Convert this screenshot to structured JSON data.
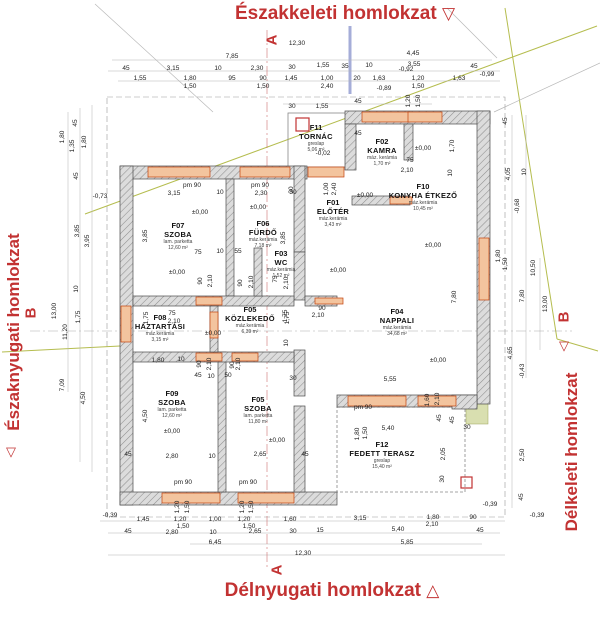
{
  "titles": {
    "top": "Északkeleti homlokzat",
    "bottom": "Délnyugati homlokzat",
    "left": "Északnyugati homlokzat",
    "right": "Délkeleti homlokzat"
  },
  "section_markers": {
    "top": "A",
    "bottom": "A",
    "left": "B",
    "right": "B"
  },
  "facade_triangles": {
    "top": "▽",
    "bottom": "△",
    "left": "▽",
    "right": "▽"
  },
  "colors": {
    "accent_red": "#c23232",
    "wall_hatch_gray": "#dcdcdc",
    "window_orange": "#e8955f",
    "roofline_olive": "#b5bd4f",
    "line_blue": "#8892cc"
  },
  "rooms": [
    {
      "code": "F11",
      "name": "TORNÁC",
      "finish": "greslap",
      "area": "5,06 m²",
      "x": 316,
      "y": 124
    },
    {
      "code": "F02",
      "name": "KAMRA",
      "finish": "máz. kerámia",
      "area": "1,70 m²",
      "x": 382,
      "y": 138
    },
    {
      "code": "F01",
      "name": "ELŐTÉR",
      "finish": "máz.kerámia",
      "area": "3,43 m²",
      "x": 333,
      "y": 199
    },
    {
      "code": "F10",
      "name": "KONYHA ÉTKEZŐ",
      "finish": "máz.kerámia",
      "area": "10,45 m²",
      "x": 423,
      "y": 183
    },
    {
      "code": "F07",
      "name": "SZOBA",
      "finish": "lam. parketta",
      "area": "12,60 m²",
      "x": 178,
      "y": 222
    },
    {
      "code": "F06",
      "name": "FÜRDŐ",
      "finish": "máz.kerámia",
      "area": "7,18 m²",
      "x": 263,
      "y": 220
    },
    {
      "code": "F03",
      "name": "WC",
      "finish": "máz.kerámia",
      "area": "1,52 m²",
      "x": 281,
      "y": 250
    },
    {
      "code": "F08",
      "name": "HÁZTARTÁSI",
      "finish": "máz.kerámia",
      "area": "3,15 m²",
      "x": 160,
      "y": 314
    },
    {
      "code": "F05",
      "name": "KÖZLEKEDŐ",
      "finish": "máz.kerámia",
      "area": "6,39 m²",
      "x": 250,
      "y": 306
    },
    {
      "code": "F04",
      "name": "NAPPALI",
      "finish": "máz.kerámia",
      "area": "34,68 m²",
      "x": 397,
      "y": 308
    },
    {
      "code": "F09",
      "name": "SZOBA",
      "finish": "lam. parketta",
      "area": "12,60 m²",
      "x": 172,
      "y": 390
    },
    {
      "code": "F05",
      "name": "SZOBA",
      "finish": "lam. parketta",
      "area": "11,80 m²",
      "x": 258,
      "y": 396
    },
    {
      "code": "F12",
      "name": "FEDETT TERASZ",
      "finish": "greslap",
      "area": "15,40 m²",
      "x": 382,
      "y": 441
    }
  ],
  "dimensions": [
    [
      "12,30",
      297,
      44
    ],
    [
      "7,85",
      232,
      57
    ],
    [
      "4,45",
      413,
      54
    ],
    [
      "45",
      126,
      69
    ],
    [
      "3,15",
      173,
      69
    ],
    [
      "10",
      218,
      69
    ],
    [
      "2,30",
      257,
      69
    ],
    [
      "30",
      292,
      68
    ],
    [
      "1,55",
      323,
      66
    ],
    [
      "35",
      345,
      67
    ],
    [
      "10",
      369,
      66
    ],
    [
      "3,55",
      414,
      65
    ],
    [
      "45",
      474,
      67
    ],
    [
      "1,55",
      140,
      79
    ],
    [
      "1,80",
      190,
      79
    ],
    [
      "1,50",
      190,
      87
    ],
    [
      "95",
      232,
      79
    ],
    [
      "90",
      263,
      79
    ],
    [
      "1,50",
      263,
      87
    ],
    [
      "1,45",
      291,
      79
    ],
    [
      "1,00",
      327,
      79
    ],
    [
      "2,40",
      327,
      87
    ],
    [
      "20",
      357,
      79
    ],
    [
      "1,63",
      379,
      79
    ],
    [
      "-0,92",
      406,
      70
    ],
    [
      "1,20",
      418,
      79
    ],
    [
      "1,50",
      418,
      87
    ],
    [
      "1,63",
      459,
      79
    ],
    [
      "-0,99",
      487,
      75
    ],
    [
      "-0,89",
      384,
      89
    ],
    [
      "30",
      292,
      107
    ],
    [
      "1,55",
      322,
      107
    ],
    [
      "45",
      358,
      102
    ],
    [
      "1,20",
      409,
      101,
      -90
    ],
    [
      "1,50",
      419,
      101,
      -90
    ],
    [
      "1,80",
      63,
      137,
      -90
    ],
    [
      "1,35",
      73,
      146,
      -90
    ],
    [
      "1,80",
      85,
      142,
      -90
    ],
    [
      "45",
      76,
      123,
      -90
    ],
    [
      "45",
      77,
      176,
      -90
    ],
    [
      "-0,73",
      100,
      197
    ],
    [
      "3,85",
      78,
      231,
      -90
    ],
    [
      "3,95",
      88,
      241,
      -90
    ],
    [
      "10",
      77,
      289,
      -90
    ],
    [
      "1,75",
      79,
      317,
      -90
    ],
    [
      "13,00",
      55,
      311,
      -90
    ],
    [
      "11,20",
      66,
      332,
      -90
    ],
    [
      "7,09",
      63,
      385,
      -90
    ],
    [
      "4,50",
      84,
      398,
      -90
    ],
    [
      "45",
      506,
      121,
      -90
    ],
    [
      "4,05",
      509,
      174,
      -90
    ],
    [
      "10",
      525,
      172,
      -90
    ],
    [
      "-0,68",
      518,
      206,
      -90
    ],
    [
      "1,80",
      499,
      256,
      -90
    ],
    [
      "1,50",
      506,
      264,
      -90
    ],
    [
      "10,50",
      534,
      268,
      -90
    ],
    [
      "7,80",
      523,
      296,
      -90
    ],
    [
      "13,00",
      546,
      304,
      -90
    ],
    [
      "7,80",
      455,
      297,
      -90
    ],
    [
      "4,65",
      511,
      353,
      -90
    ],
    [
      "-0,43",
      523,
      371,
      -90
    ],
    [
      "2,50",
      523,
      455,
      -90
    ],
    [
      "45",
      522,
      497,
      -90
    ],
    [
      "-0,39",
      110,
      516
    ],
    [
      "1,45",
      143,
      520
    ],
    [
      "1,20",
      178,
      507,
      -90
    ],
    [
      "1,50",
      188,
      507,
      -90
    ],
    [
      "1,20",
      180,
      520
    ],
    [
      "1,50",
      183,
      527
    ],
    [
      "1,00",
      215,
      520
    ],
    [
      "1,20",
      243,
      507,
      -90
    ],
    [
      "1,50",
      252,
      507,
      -90
    ],
    [
      "1,20",
      244,
      520
    ],
    [
      "1,50",
      249,
      527
    ],
    [
      "1,60",
      290,
      520
    ],
    [
      "45",
      128,
      532
    ],
    [
      "2,80",
      172,
      533
    ],
    [
      "10",
      213,
      533
    ],
    [
      "2,65",
      255,
      532
    ],
    [
      "30",
      293,
      532
    ],
    [
      "15",
      320,
      531
    ],
    [
      "6,45",
      215,
      543
    ],
    [
      "12,30",
      303,
      554
    ],
    [
      "3,15",
      360,
      519
    ],
    [
      "1,80",
      433,
      518
    ],
    [
      "2,10",
      432,
      525
    ],
    [
      "90",
      473,
      518
    ],
    [
      "5,40",
      398,
      530
    ],
    [
      "45",
      480,
      531
    ],
    [
      "5,85",
      407,
      543
    ],
    [
      "-0,39",
      490,
      505
    ],
    [
      "-0,39",
      537,
      516
    ],
    [
      "pm 90",
      192,
      186
    ],
    [
      "3,15",
      174,
      194
    ],
    [
      "10",
      220,
      193
    ],
    [
      "pm 90",
      260,
      186
    ],
    [
      "2,30",
      261,
      194
    ],
    [
      "30",
      293,
      193
    ],
    [
      "3,85",
      146,
      236,
      -90
    ],
    [
      "75",
      198,
      253
    ],
    [
      "10",
      220,
      252
    ],
    [
      "55",
      238,
      252
    ],
    [
      "3,85",
      284,
      238,
      -90
    ],
    [
      "90",
      201,
      281,
      -90
    ],
    [
      "2,10",
      211,
      281,
      -90
    ],
    [
      "90",
      241,
      283,
      -90
    ],
    [
      "2,10",
      252,
      282,
      -90
    ],
    [
      "45",
      358,
      134
    ],
    [
      "-0,02",
      323,
      154
    ],
    [
      "75",
      410,
      161
    ],
    [
      "2,10",
      407,
      171
    ],
    [
      "1,70",
      453,
      146,
      -90
    ],
    [
      "10",
      451,
      173,
      -90
    ],
    [
      "30",
      292,
      190,
      -90
    ],
    [
      "1,00",
      327,
      189,
      -90
    ],
    [
      "2,40",
      335,
      189,
      -90
    ],
    [
      "75",
      276,
      279,
      -90
    ],
    [
      "2,10",
      287,
      283,
      -90
    ],
    [
      "90",
      322,
      309
    ],
    [
      "2,10",
      318,
      316
    ],
    [
      "1,75",
      288,
      318,
      -90
    ],
    [
      "10",
      287,
      343,
      -90
    ],
    [
      "75",
      172,
      314
    ],
    [
      "2,10",
      174,
      322
    ],
    [
      "1,80",
      158,
      361
    ],
    [
      "10",
      181,
      360
    ],
    [
      "90",
      200,
      364,
      -90
    ],
    [
      "2,10",
      210,
      364,
      -90
    ],
    [
      "45",
      198,
      376
    ],
    [
      "10",
      211,
      377
    ],
    [
      "50",
      228,
      376
    ],
    [
      "90",
      233,
      365,
      -90
    ],
    [
      "2,10",
      239,
      364,
      -90
    ],
    [
      "1,75",
      147,
      318,
      -90
    ],
    [
      "1,75",
      286,
      316,
      -90
    ],
    [
      "30",
      293,
      379
    ],
    [
      "5,55",
      390,
      380
    ],
    [
      "pm 90",
      363,
      408
    ],
    [
      "1,60",
      428,
      400,
      -90
    ],
    [
      "2,10",
      438,
      399,
      -90
    ],
    [
      "45",
      440,
      418,
      -90
    ],
    [
      "45",
      453,
      420,
      -90
    ],
    [
      "30",
      467,
      428
    ],
    [
      "2,05",
      444,
      454,
      -90
    ],
    [
      "30",
      443,
      479,
      -90
    ],
    [
      "5,40",
      388,
      429
    ],
    [
      "1,80",
      358,
      434,
      -90
    ],
    [
      "1,50",
      366,
      433,
      -90
    ],
    [
      "4,50",
      146,
      416,
      -90
    ],
    [
      "2,80",
      172,
      457
    ],
    [
      "10",
      212,
      457
    ],
    [
      "2,65",
      260,
      455
    ],
    [
      "45",
      128,
      455
    ],
    [
      "45",
      305,
      455
    ],
    [
      "pm 90",
      183,
      483
    ],
    [
      "pm 90",
      248,
      483
    ],
    [
      "±0,00",
      200,
      213
    ],
    [
      "±0,00",
      258,
      208
    ],
    [
      "±0,00",
      365,
      196
    ],
    [
      "±0,00",
      423,
      149
    ],
    [
      "±0,00",
      433,
      246
    ],
    [
      "±0,00",
      338,
      271
    ],
    [
      "±0,00",
      177,
      273
    ],
    [
      "±0,00",
      213,
      334
    ],
    [
      "±0,00",
      438,
      361
    ],
    [
      "±0,00",
      172,
      432
    ],
    [
      "±0,00",
      277,
      441
    ]
  ]
}
